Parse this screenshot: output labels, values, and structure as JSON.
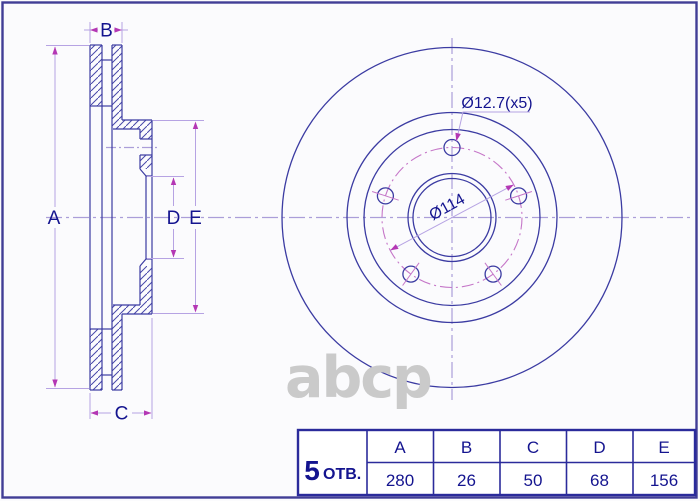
{
  "drawing": {
    "dimension_labels": {
      "a": "A",
      "b": "B",
      "c": "C",
      "d": "D",
      "e": "E"
    },
    "callouts": {
      "bolt_holes": "Ø12.7(x5)",
      "pcd": "Ø114"
    }
  },
  "table": {
    "holes_count": "5",
    "holes_label": "ОТВ.",
    "headers": [
      "A",
      "B",
      "C",
      "D",
      "E"
    ],
    "values": [
      "280",
      "26",
      "50",
      "68",
      "156"
    ]
  },
  "watermark": {
    "text": "abcp"
  },
  "colors": {
    "line_blue": "#3b3ba2",
    "centerline_violet": "#ab9ed9",
    "dim_line_violet": "#b6a3e3",
    "arrow_magenta": "#b437b4",
    "pcd_magenta": "#c576c8",
    "label_navy": "#14148f",
    "table_border_navy": "#2b2b9b",
    "watermark_gray": "#cacaca",
    "page_border": "#413d96"
  }
}
